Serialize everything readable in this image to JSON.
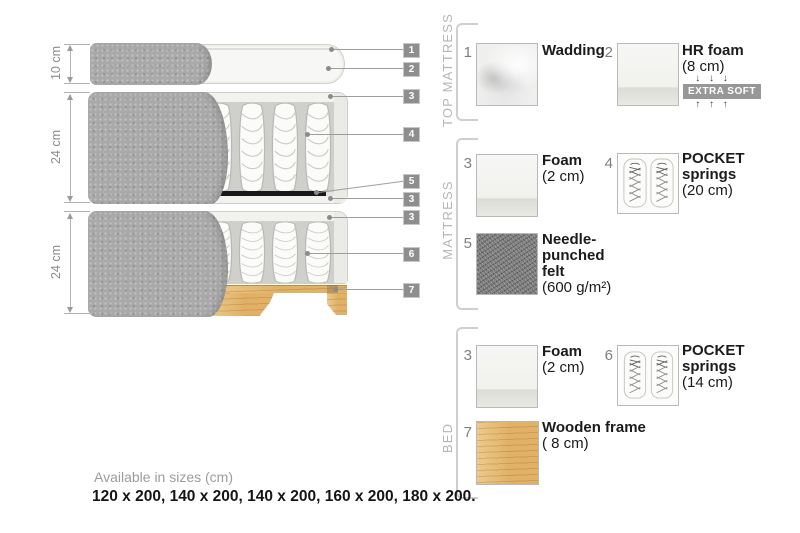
{
  "diagram": {
    "dim_labels": [
      "10 cm",
      "24 cm",
      "24 cm"
    ],
    "tags": [
      "1",
      "2",
      "3",
      "4",
      "5",
      "3",
      "3",
      "6",
      "7"
    ]
  },
  "legend": {
    "groups": [
      {
        "title": "TOP MATTRESS",
        "items": [
          {
            "num": "1",
            "line1": "Wadding"
          },
          {
            "num": "2",
            "line1": "HR foam",
            "size": "(8 cm)",
            "arrows_down": "↓ ↓ ↓",
            "badge": "EXTRA SOFT",
            "arrows_up": "↑ ↑ ↑"
          }
        ]
      },
      {
        "title": "MATTRESS",
        "items": [
          {
            "num": "3",
            "line1": "Foam",
            "size": "(2 cm)"
          },
          {
            "num": "4",
            "line1": "POCKET",
            "line2": "springs",
            "size": "(20 cm)"
          },
          {
            "num": "5",
            "line1": "Needle-",
            "line2": "punched",
            "line3": "felt",
            "size": "(600 g/m²)"
          }
        ]
      },
      {
        "title": "BED",
        "items": [
          {
            "num": "3",
            "line1": "Foam",
            "size": "(2 cm)"
          },
          {
            "num": "6",
            "line1": "POCKET",
            "line2": "springs",
            "size": "(14 cm)"
          },
          {
            "num": "7",
            "line1": "Wooden frame",
            "size": "( 8  cm)"
          }
        ]
      }
    ]
  },
  "footer": {
    "caption": "Available in sizes (cm)",
    "sizes": "120 x 200, 140 x 200, 140 x 200, 160 x 200, 180 x 200."
  },
  "colors": {
    "tag_bg": "#8e8e8e",
    "badge_bg": "#979797",
    "fabric_gray": "#a9a9a9",
    "wood_tan": "#e0b166",
    "felt_black": "#181818"
  }
}
